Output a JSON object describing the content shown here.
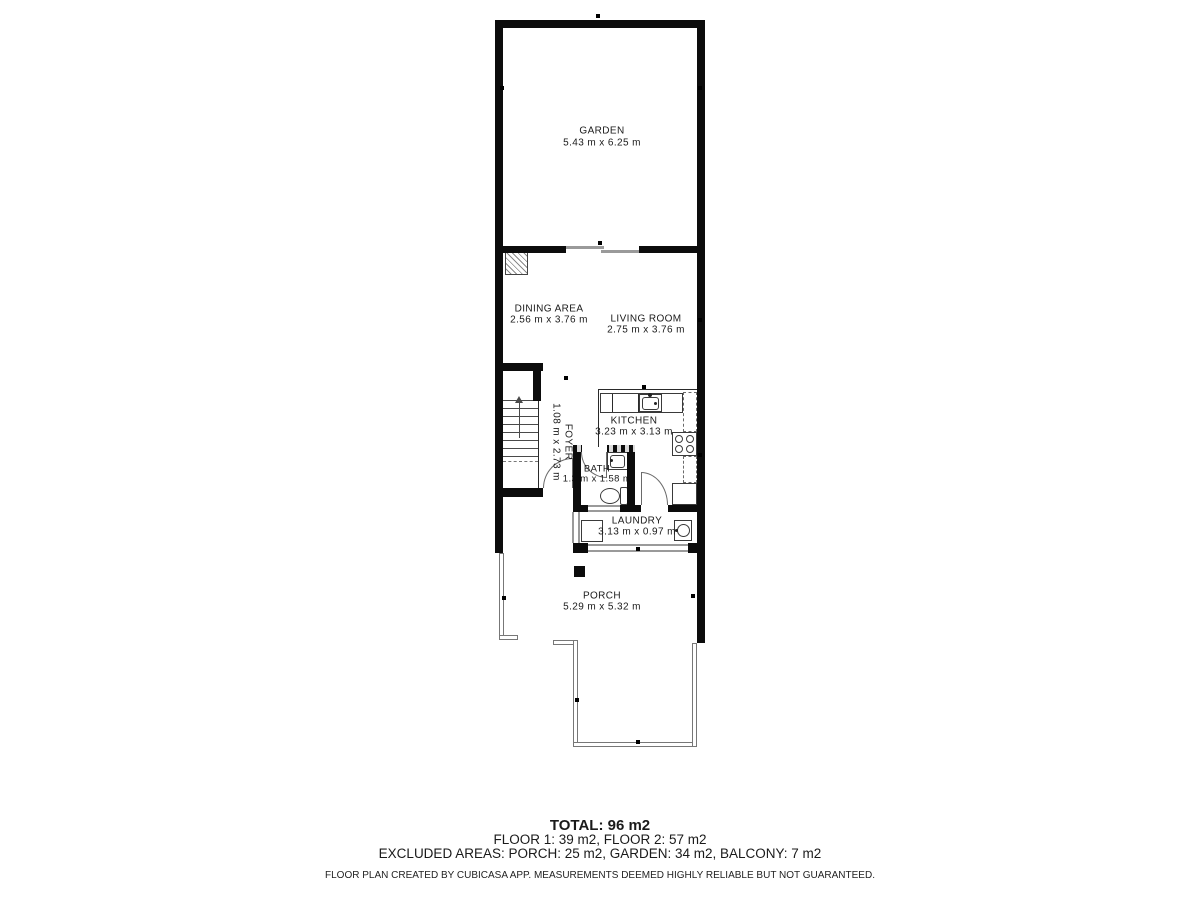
{
  "plan": {
    "rooms": [
      {
        "id": "garden",
        "name": "GARDEN",
        "dims": "5.43 m x 6.25 m"
      },
      {
        "id": "dining",
        "name": "DINING AREA",
        "dims": "2.56 m x 3.76 m"
      },
      {
        "id": "living",
        "name": "LIVING ROOM",
        "dims": "2.75 m x 3.76 m"
      },
      {
        "id": "kitchen",
        "name": "KITCHEN",
        "dims": "3.23 m x 3.13 m"
      },
      {
        "id": "foyer",
        "name": "FOYER",
        "dims": "1.08 m x 2.73 m"
      },
      {
        "id": "bath",
        "name": "BATH",
        "dims": "1.3 m x 1.58 m"
      },
      {
        "id": "laundry",
        "name": "LAUNDRY",
        "dims": "3.13 m x 0.97 m"
      },
      {
        "id": "porch",
        "name": "PORCH",
        "dims": "5.29 m x 5.32 m"
      }
    ],
    "fixtures": [
      "staircase",
      "kitchen-sink",
      "stove",
      "bath-sink",
      "toilet",
      "washer",
      "fireplace-flue",
      "porch-post"
    ],
    "colors": {
      "wall": "#0c0c0c",
      "window": "#9a9a9a",
      "background": "#ffffff"
    }
  },
  "summary": {
    "total": "TOTAL: 96 m2",
    "floors": "FLOOR 1: 39 m2, FLOOR 2: 57 m2",
    "excluded": "EXCLUDED AREAS: PORCH: 25 m2, GARDEN: 34 m2, BALCONY: 7 m2",
    "disclaimer": "FLOOR PLAN CREATED BY CUBICASA APP. MEASUREMENTS DEEMED HIGHLY RELIABLE BUT NOT GUARANTEED."
  }
}
